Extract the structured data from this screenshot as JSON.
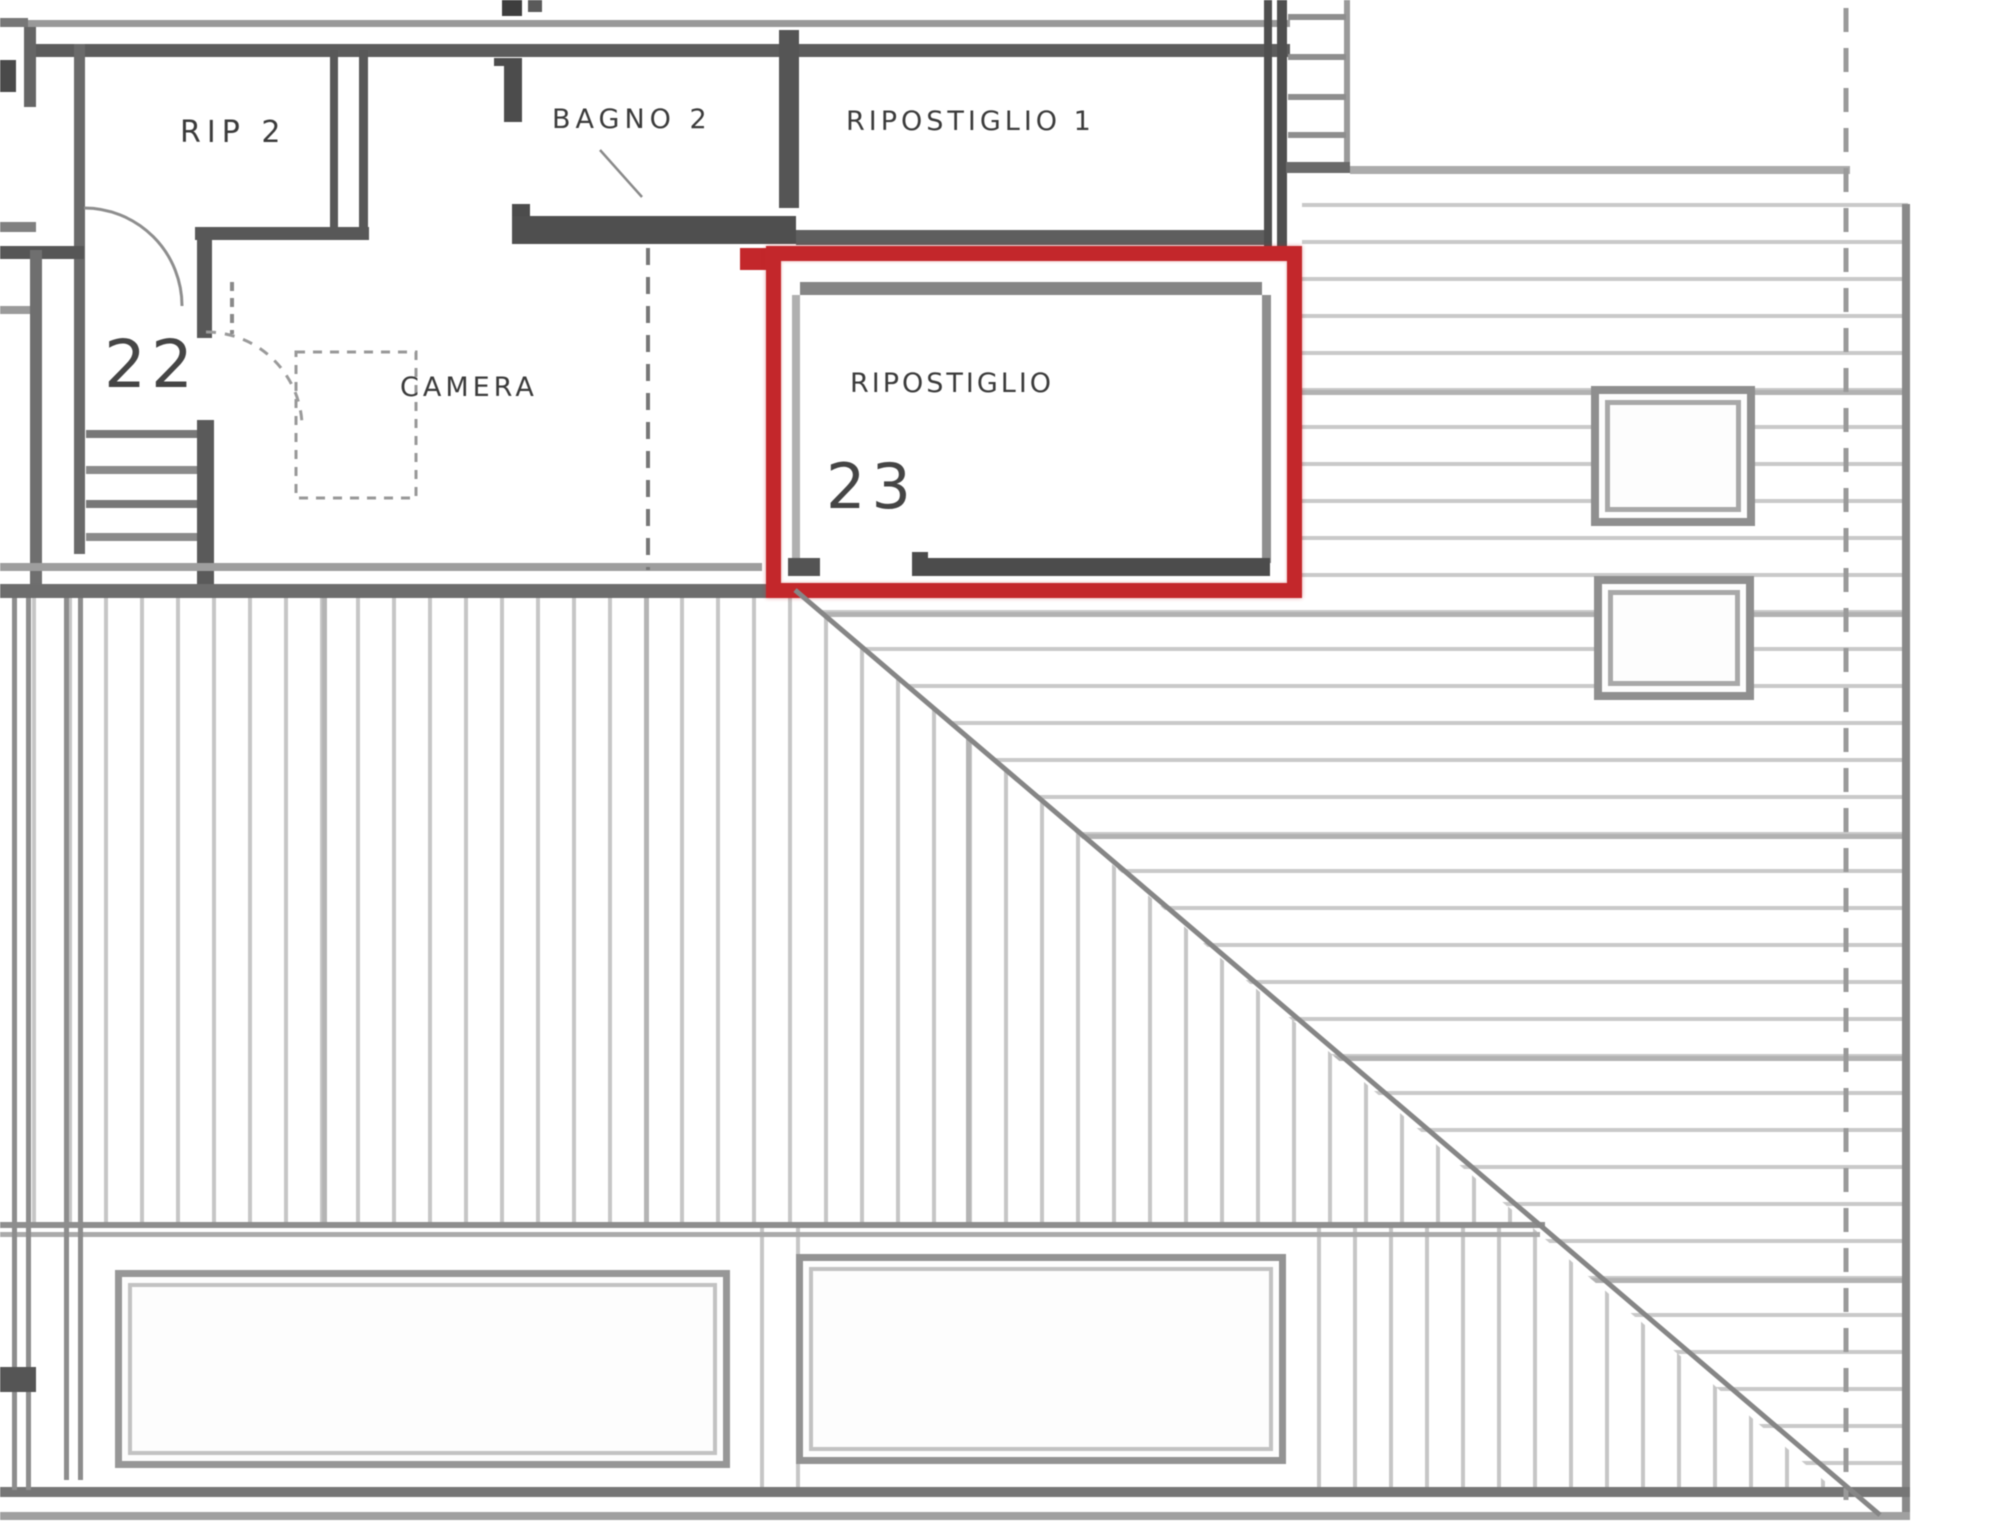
{
  "plan": {
    "type": "floor-plan-scan",
    "labels": {
      "rip2": "RIP 2",
      "bagno2": "BAGNO 2",
      "ripostiglio1": "RIPOSTIGLIO 1",
      "camera": "CAMERA",
      "ripostiglio23": "RIPOSTIGLIO",
      "number23": "23",
      "number22": "22"
    },
    "highlight": {
      "room": "RIPOSTIGLIO 23",
      "color": "#c3272b"
    },
    "colors": {
      "wall_dark": "#4f4f4f",
      "line_medium": "#8d8d8d",
      "hatch_light": "#c8c8c8",
      "text": "#3b3b3b",
      "background": "#ffffff"
    }
  }
}
